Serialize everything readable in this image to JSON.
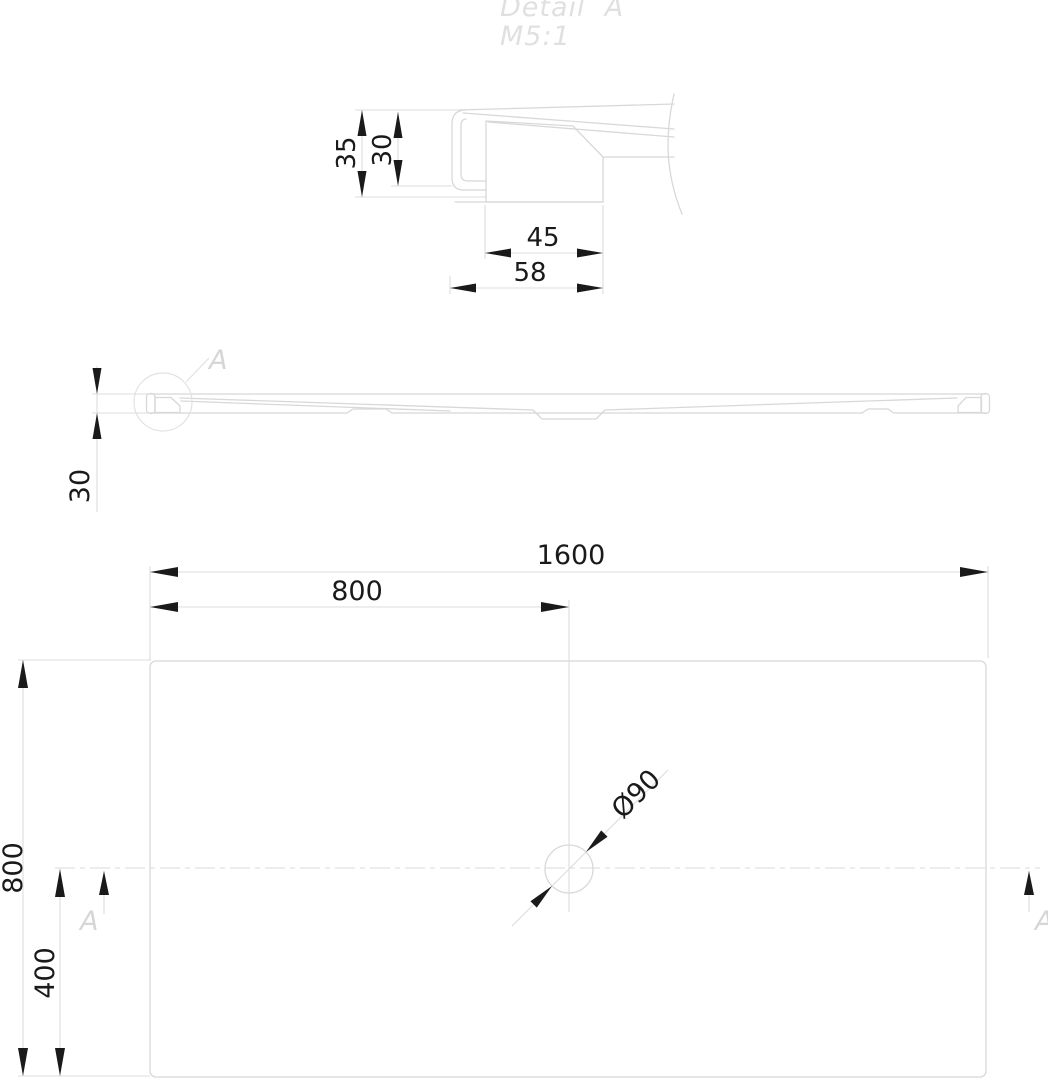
{
  "meta": {
    "type": "technical-drawing",
    "subject": "shower-tray",
    "background": "#ffffff"
  },
  "detail_view": {
    "title": "Detail  A",
    "scale": "M5:1",
    "dim_height_outer": "35",
    "dim_height_inner": "30",
    "dim_width_inner": "45",
    "dim_width_outer": "58"
  },
  "side_view": {
    "dim_height": "30",
    "detail_label": "A"
  },
  "plan_view": {
    "dim_width": "1600",
    "dim_width_half": "800",
    "dim_depth": "800",
    "dim_depth_half": "400",
    "drain_diameter": "Ø90",
    "section_label_left": "A",
    "section_label_right": "A"
  },
  "colors": {
    "geometry_line": "#d8d8d8",
    "extension_line": "#dcdcdc",
    "dimension_ink": "#1a1a1a",
    "gray_label": "#d6d6d6",
    "title_gray": "#e0e0e0"
  }
}
